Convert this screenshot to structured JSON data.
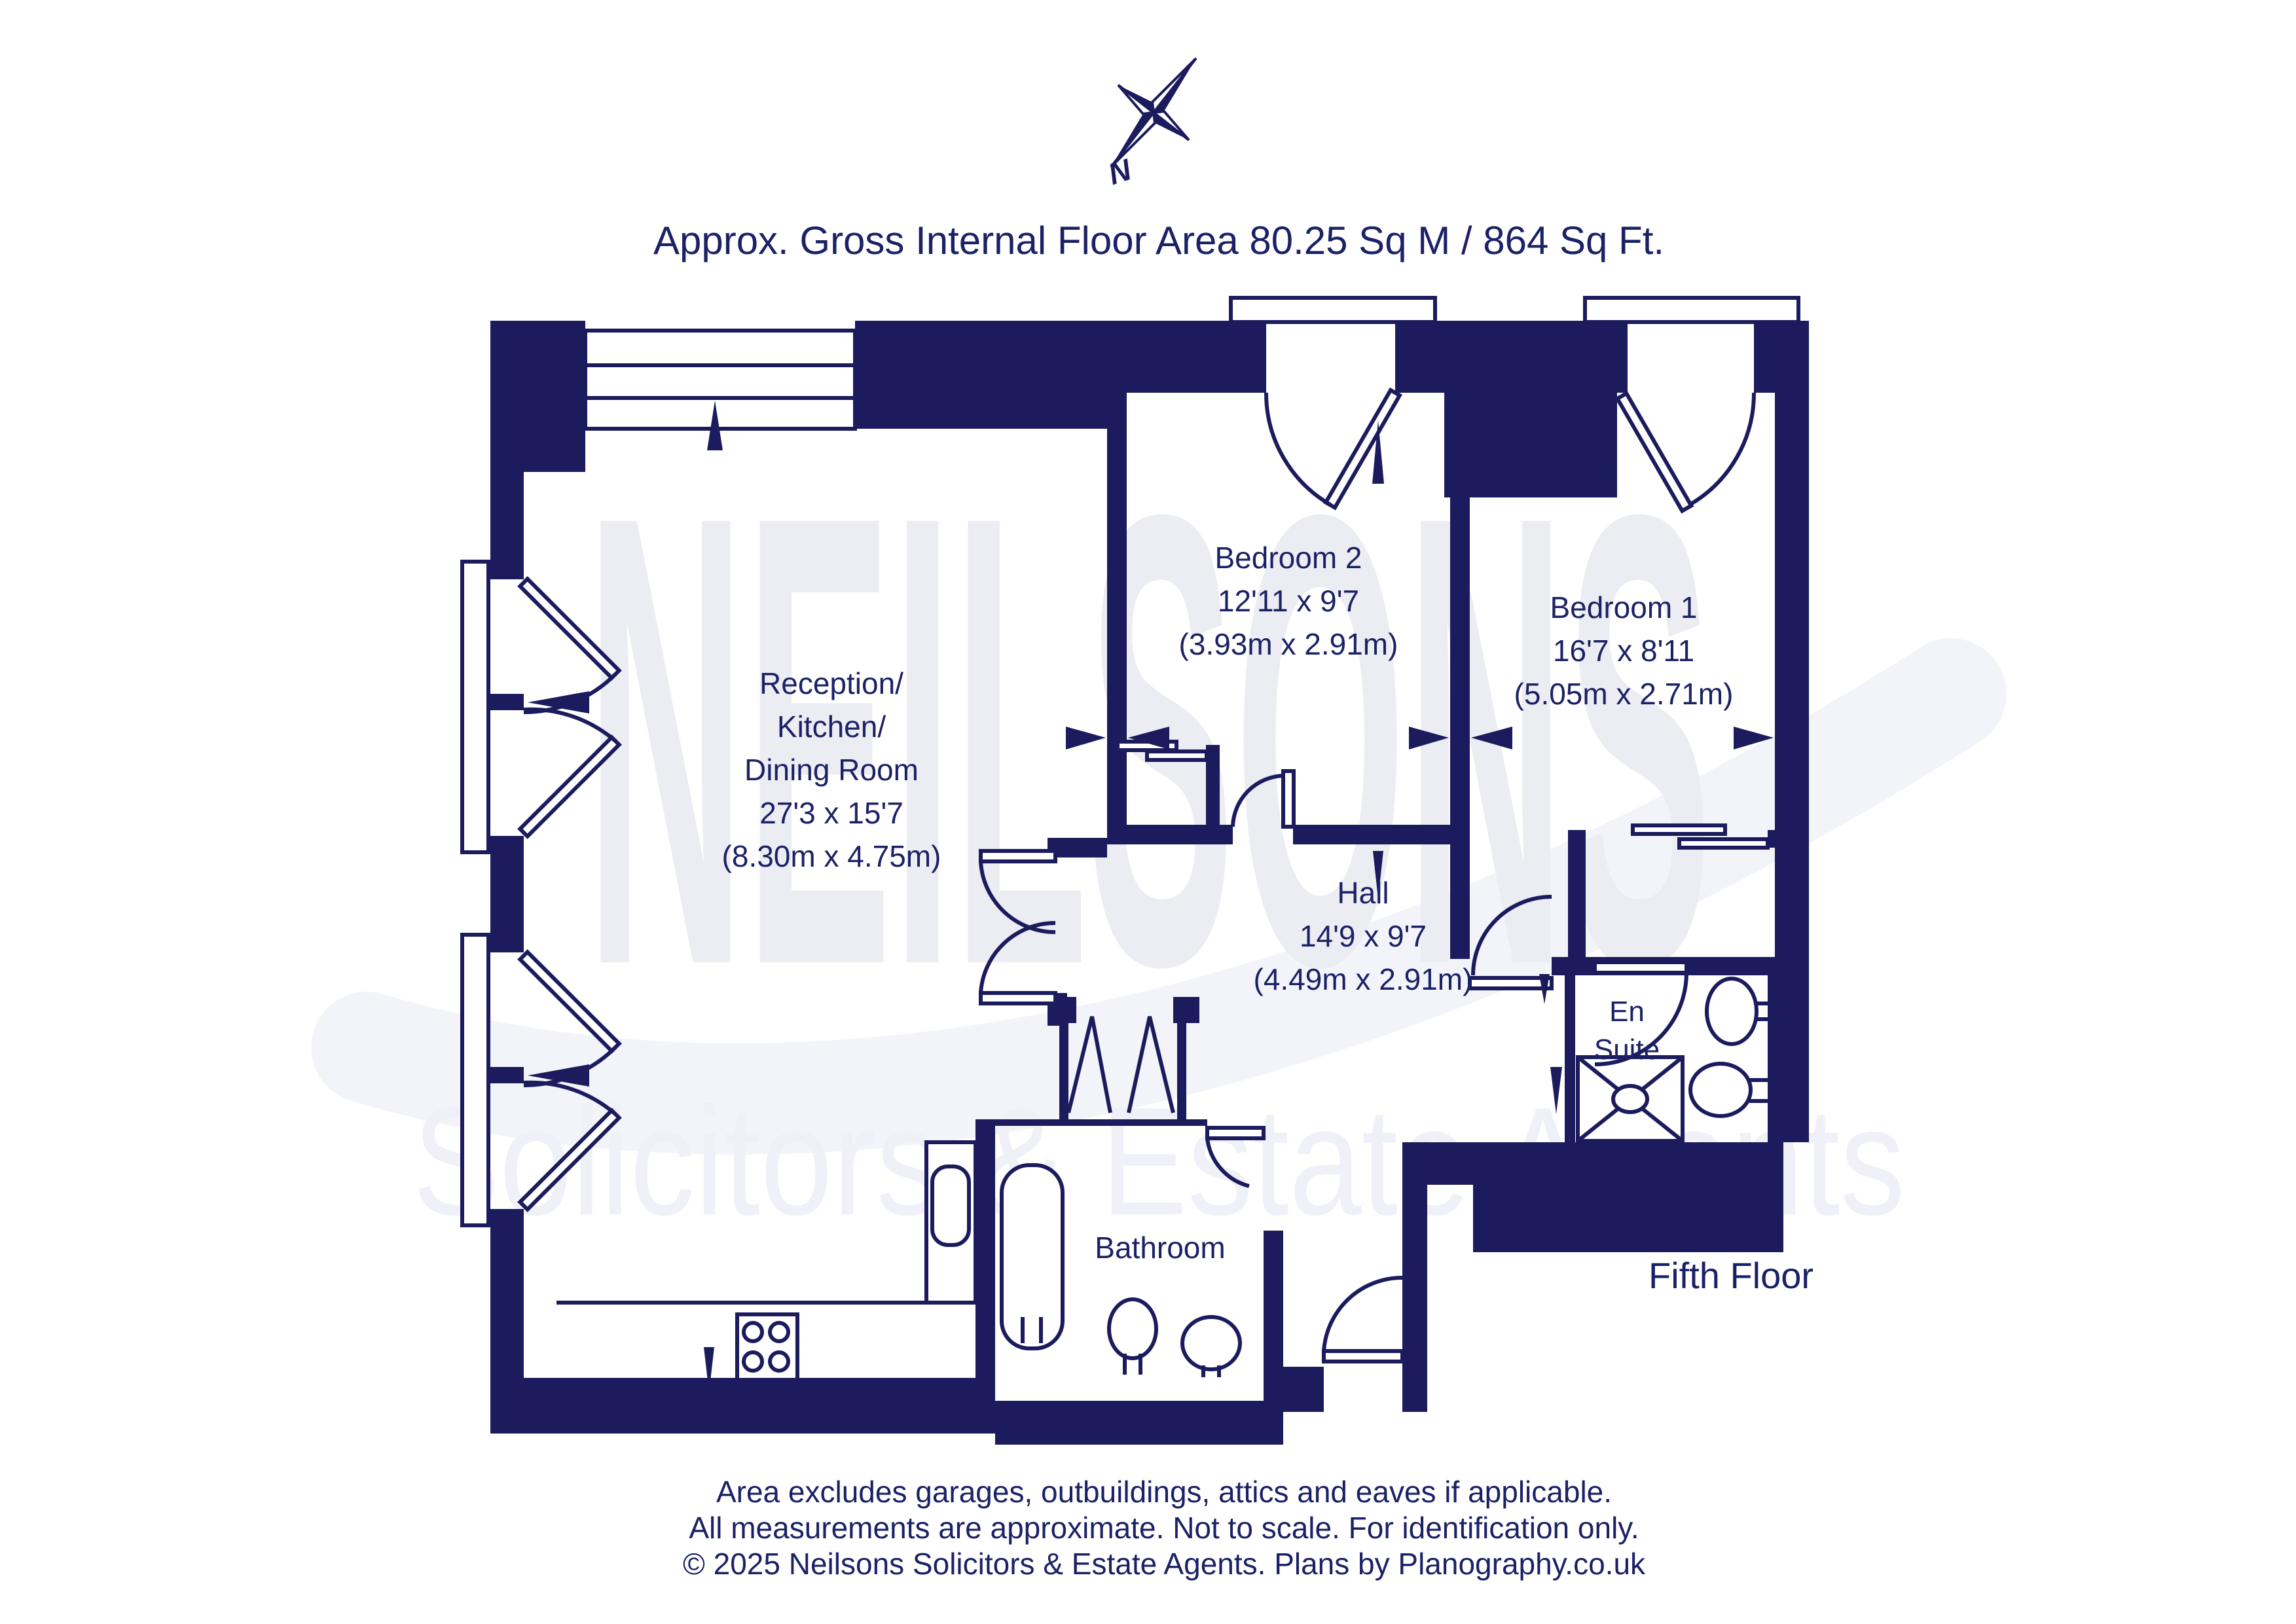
{
  "title": "Approx. Gross Internal Floor Area 80.25 Sq M / 864 Sq Ft.",
  "floor_label": "Fifth Floor",
  "compass": {
    "label": "N"
  },
  "watermark": {
    "line1": "NEILSONS",
    "line2": "Solicitors & Estate Agents"
  },
  "rooms": {
    "reception": {
      "name_lines": [
        "Reception/",
        "Kitchen/",
        "Dining Room"
      ],
      "dims_imperial": "27'3 x 15'7",
      "dims_metric": "(8.30m x 4.75m)"
    },
    "bedroom2": {
      "name": "Bedroom 2",
      "dims_imperial": "12'11 x 9'7",
      "dims_metric": "(3.93m x 2.91m)"
    },
    "bedroom1": {
      "name": "Bedroom 1",
      "dims_imperial": "16'7 x 8'11",
      "dims_metric": "(5.05m x 2.71m)"
    },
    "hall": {
      "name": "Hall",
      "dims_imperial": "14'9 x 9'7",
      "dims_metric": "(4.49m x 2.91m)"
    },
    "ensuite": {
      "line1": "En",
      "line2": "Suite"
    },
    "bathroom": {
      "name": "Bathroom"
    }
  },
  "footer": {
    "line1": "Area excludes garages, outbuildings, attics and eaves if applicable.",
    "line2": "All measurements are approximate. Not to scale. For identification only.",
    "line3": "© 2025 Neilsons Solicitors & Estate Agents. Plans by Planography.co.uk"
  },
  "colors": {
    "plan_navy": "#1b1b5e",
    "text_navy": "#1b2166",
    "watermark": "#ececf3",
    "watermark_light": "#f0f1f8",
    "swoosh": "#f3f4f9"
  }
}
